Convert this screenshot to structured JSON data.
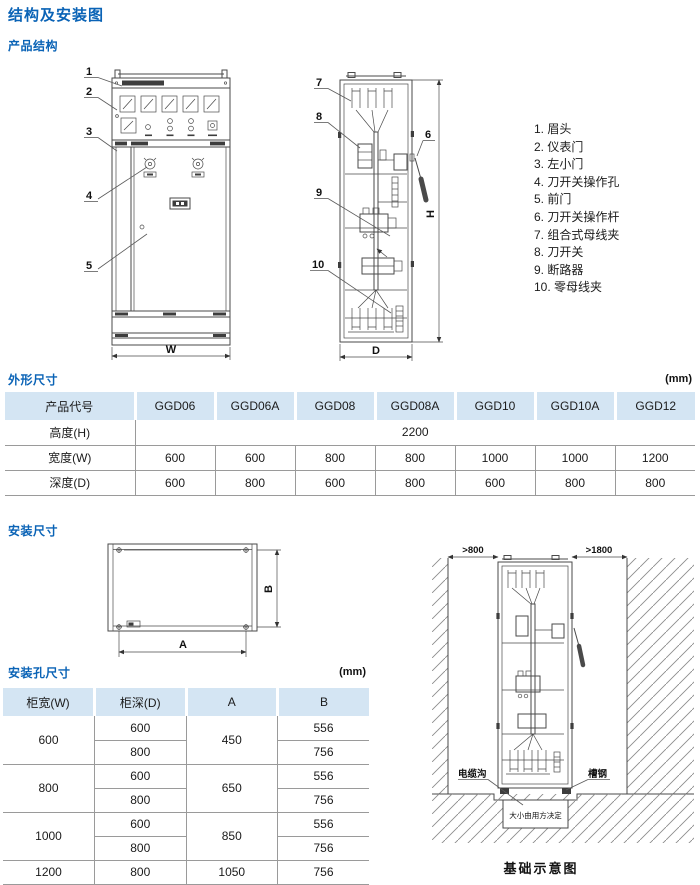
{
  "page": {
    "title": "结构及安装图",
    "unit": "(mm)"
  },
  "sections": {
    "product_structure": "产品结构",
    "outer_dim": "外形尺寸",
    "install_dim": "安装尺寸",
    "install_hole": "安装孔尺寸"
  },
  "legend": {
    "items": [
      "1. 眉头",
      "2. 仪表门",
      "3. 左小门",
      "4. 刀开关操作孔",
      "5. 前门",
      "6. 刀开关操作杆",
      "7. 组合式母线夹",
      "8. 刀开关",
      "9. 断路器",
      "10. 零母线夹"
    ]
  },
  "front_view": {
    "n1": "1",
    "n2": "2",
    "n3": "3",
    "n4": "4",
    "n5": "5",
    "dim_w": "W"
  },
  "side_view": {
    "n6": "6",
    "n7": "7",
    "n8": "8",
    "n9": "9",
    "n10": "10",
    "dim_h": "H",
    "dim_d": "D"
  },
  "top_view": {
    "dim_a": "A",
    "dim_b": "B"
  },
  "foundation": {
    "clear_left": ">800",
    "clear_right": ">1800",
    "cable_trench": "电缆沟",
    "channel_steel": "槽钢",
    "trench_note": "大小由用方决定",
    "caption": "基础示意图"
  },
  "outer_dim_table": {
    "headers": [
      "产品代号",
      "GGD06",
      "GGD06A",
      "GGD08",
      "GGD08A",
      "GGD10",
      "GGD10A",
      "GGD12"
    ],
    "row_height": {
      "label": "高度(H)",
      "value": "2200"
    },
    "row_width": {
      "label": "宽度(W)",
      "values": [
        "600",
        "600",
        "800",
        "800",
        "1000",
        "1000",
        "1200"
      ]
    },
    "row_depth": {
      "label": "深度(D)",
      "values": [
        "600",
        "800",
        "600",
        "800",
        "600",
        "800",
        "800"
      ]
    }
  },
  "install_hole_table": {
    "headers": [
      "柜宽(W)",
      "柜深(D)",
      "A",
      "B"
    ],
    "groups": [
      {
        "w": "600",
        "a": "450",
        "d1": "600",
        "b1": "556",
        "d2": "800",
        "b2": "756"
      },
      {
        "w": "800",
        "a": "650",
        "d1": "600",
        "b1": "556",
        "d2": "800",
        "b2": "756"
      },
      {
        "w": "1000",
        "a": "850",
        "d1": "600",
        "b1": "556",
        "d2": "800",
        "b2": "756"
      },
      {
        "w": "1200",
        "a": "1050",
        "d1": "800",
        "b1": "756"
      }
    ]
  },
  "colors": {
    "heading_blue": "#0a63b6",
    "table_header_bg": "#d4e5f3"
  }
}
